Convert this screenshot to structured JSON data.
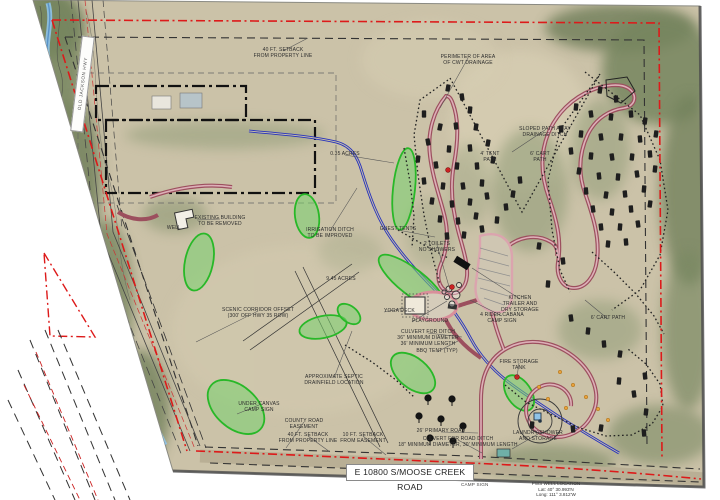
{
  "title_block": {
    "road_label": "E 10800 S/MOOSE CREEK ROAD",
    "camp_sign": "CAMP SIGN",
    "street_sign": "OLD JACKSON HWY",
    "well_note": [
      "PWS WELL LOCATION",
      "Lat: 40° 30.993'N",
      "Long: 111° 3.812'W"
    ]
  },
  "colors": {
    "boundary_red": "#dd1a1a",
    "setback_black": "#333333",
    "road_maroon": "#9c4f5e",
    "road_pink_inner": "#ddb0b8",
    "ditch_blue": "#2531bd",
    "creek_blue": "#8fc3e8",
    "vegetation_green": "#28b828",
    "tent_black": "#1e1e1e",
    "aerial_tan": "#cbc2a8"
  },
  "map": {
    "labels": [
      {
        "t": "40 FT. SETBACK\nFROM PROPERTY LINE",
        "x": 283,
        "y": 48,
        "l": [
          308,
          38
        ]
      },
      {
        "t": "PERIMETER OF AREA\nOF CWT DRAINAGE",
        "x": 468,
        "y": 55,
        "l": [
          440,
          108
        ]
      },
      {
        "t": "SLOPED PATH AWAY\nDRAINAGE DITCH",
        "x": 545,
        "y": 127,
        "l": [
          512,
          152
        ]
      },
      {
        "t": "4' TENT\nPATH",
        "x": 490,
        "y": 152
      },
      {
        "t": "6' CART\nPATH",
        "x": 540,
        "y": 152
      },
      {
        "t": "6' CART PATH",
        "x": 608,
        "y": 316,
        "l": [
          585,
          300
        ]
      },
      {
        "t": "0.35 ACRES",
        "x": 345,
        "y": 152,
        "l": [
          394,
          163
        ]
      },
      {
        "t": "GUEST TENTS",
        "x": 398,
        "y": 227,
        "l": [
          435,
          237
        ]
      },
      {
        "t": "2 TOILETS\nNO SHOWERS",
        "x": 437,
        "y": 242,
        "l": [
          450,
          290
        ]
      },
      {
        "t": "EXISTING BUILDING\nTO BE REMOVED",
        "x": 220,
        "y": 216,
        "l": [
          197,
          220
        ]
      },
      {
        "t": "WELL",
        "x": 174,
        "y": 226
      },
      {
        "t": "IRRIGATION DITCH\nTO BE IMPROVED",
        "x": 330,
        "y": 228,
        "l": [
          357,
          188
        ]
      },
      {
        "t": "SCENIC CORRIDOR OFFSET\n(300' OFF HWY 35 ROW)",
        "x": 258,
        "y": 308,
        "l": [
          196,
          342
        ]
      },
      {
        "t": "9.45 ACRES",
        "x": 341,
        "y": 277
      },
      {
        "t": "YOGA DECK",
        "x": 384,
        "y": 309,
        "a": "left",
        "l": [
          404,
          308
        ]
      },
      {
        "t": "PLAYGROUND",
        "x": 412,
        "y": 319,
        "a": "left",
        "l": [
          447,
          301
        ]
      },
      {
        "t": "CULVERT FOR DITCH\n36\" MINIMUM DIAMETER\n36' MINIMUM LENGTH",
        "x": 428,
        "y": 330,
        "l": [
          462,
          337
        ]
      },
      {
        "t": "BBQ TENT (TYP)",
        "x": 437,
        "y": 349,
        "l": [
          458,
          341
        ]
      },
      {
        "t": "KITCHEN\nTRAILER AND\nDRY STORAGE",
        "x": 520,
        "y": 296,
        "l": [
          472,
          268
        ]
      },
      {
        "t": "4 RIDER CABANA\nCAMP SIGN",
        "x": 502,
        "y": 313,
        "l": [
          470,
          300
        ]
      },
      {
        "t": "FIRE STORAGE\nTANK",
        "x": 519,
        "y": 360,
        "l": [
          517,
          377
        ]
      },
      {
        "t": "LAUNDRY/SHOWER\nAND STORAGE",
        "x": 538,
        "y": 431,
        "l": [
          512,
          449
        ]
      },
      {
        "t": "UNDER CANVAS\nCAMP SIGN",
        "x": 259,
        "y": 402,
        "l": [
          237,
          414
        ]
      },
      {
        "t": "COUNTY ROAD\nEASEMENT",
        "x": 304,
        "y": 419,
        "l": [
          286,
          448
        ]
      },
      {
        "t": "40 FT. SETBACK\nFROM PROPERTY LINE",
        "x": 308,
        "y": 433,
        "l": [
          330,
          452
        ]
      },
      {
        "t": "10 FT. SETBACK\nFROM EASEMENT",
        "x": 363,
        "y": 433,
        "l": [
          386,
          455
        ]
      },
      {
        "t": "APPROXIMATE SEPTIC\nDRAINFIELD LOCATION",
        "x": 334,
        "y": 375,
        "l": [
          352,
          331
        ]
      },
      {
        "t": "26' PRIMARY ROAD",
        "x": 441,
        "y": 429,
        "l": [
          478,
          433
        ]
      },
      {
        "t": "CULVERT FOR ROAD DITCH\n18\" MINIMUM DIAMETER, 30' MINIMUM LENGTH",
        "x": 458,
        "y": 437,
        "l": [
          482,
          453
        ]
      }
    ],
    "green_areas": [
      [
        404,
        189,
        11,
        41,
        6
      ],
      [
        307,
        216,
        12,
        22,
        -8
      ],
      [
        199,
        262,
        14,
        29,
        12
      ],
      [
        323,
        327,
        24,
        11,
        -12
      ],
      [
        412,
        282,
        41,
        13,
        38
      ],
      [
        236,
        407,
        33,
        21,
        42
      ],
      [
        413,
        373,
        26,
        15,
        40
      ],
      [
        519,
        393,
        20,
        12,
        55
      ],
      [
        349,
        314,
        13,
        8,
        38
      ]
    ],
    "tents": [
      [
        448,
        88,
        10
      ],
      [
        462,
        97,
        -8
      ],
      [
        470,
        110,
        5
      ],
      [
        424,
        114,
        0
      ],
      [
        440,
        127,
        12
      ],
      [
        456,
        126,
        -6
      ],
      [
        476,
        127,
        8
      ],
      [
        428,
        142,
        -10
      ],
      [
        449,
        149,
        4
      ],
      [
        470,
        148,
        -5
      ],
      [
        488,
        143,
        10
      ],
      [
        418,
        159,
        6
      ],
      [
        436,
        165,
        -8
      ],
      [
        457,
        166,
        5
      ],
      [
        477,
        166,
        -4
      ],
      [
        493,
        160,
        8
      ],
      [
        424,
        181,
        -6
      ],
      [
        443,
        186,
        6
      ],
      [
        463,
        186,
        -8
      ],
      [
        482,
        183,
        4
      ],
      [
        432,
        201,
        8
      ],
      [
        452,
        204,
        -5
      ],
      [
        470,
        202,
        6
      ],
      [
        487,
        196,
        -8
      ],
      [
        440,
        219,
        5
      ],
      [
        458,
        221,
        -6
      ],
      [
        476,
        216,
        8
      ],
      [
        447,
        236,
        -5
      ],
      [
        464,
        235,
        6
      ],
      [
        482,
        229,
        -8
      ],
      [
        497,
        220,
        5
      ],
      [
        506,
        207,
        -6
      ],
      [
        513,
        194,
        8
      ],
      [
        520,
        180,
        -5
      ],
      [
        600,
        90,
        8
      ],
      [
        616,
        99,
        -6
      ],
      [
        576,
        107,
        5
      ],
      [
        591,
        114,
        -8
      ],
      [
        611,
        117,
        6
      ],
      [
        631,
        114,
        -5
      ],
      [
        645,
        121,
        8
      ],
      [
        561,
        129,
        -6
      ],
      [
        581,
        134,
        5
      ],
      [
        601,
        137,
        -8
      ],
      [
        621,
        137,
        6
      ],
      [
        640,
        139,
        -5
      ],
      [
        656,
        134,
        8
      ],
      [
        571,
        151,
        -6
      ],
      [
        591,
        156,
        5
      ],
      [
        612,
        157,
        -8
      ],
      [
        632,
        157,
        6
      ],
      [
        650,
        154,
        -5
      ],
      [
        579,
        171,
        8
      ],
      [
        599,
        176,
        -6
      ],
      [
        618,
        177,
        5
      ],
      [
        637,
        174,
        -8
      ],
      [
        655,
        169,
        6
      ],
      [
        586,
        191,
        -5
      ],
      [
        606,
        195,
        8
      ],
      [
        625,
        194,
        -6
      ],
      [
        644,
        189,
        5
      ],
      [
        593,
        209,
        -8
      ],
      [
        612,
        212,
        6
      ],
      [
        631,
        209,
        -5
      ],
      [
        650,
        204,
        8
      ],
      [
        601,
        227,
        -6
      ],
      [
        620,
        227,
        5
      ],
      [
        638,
        224,
        -8
      ],
      [
        608,
        244,
        6
      ],
      [
        626,
        242,
        -5
      ],
      [
        539,
        246,
        8
      ],
      [
        563,
        261,
        -6
      ],
      [
        548,
        284,
        5
      ],
      [
        571,
        318,
        -8
      ],
      [
        588,
        331,
        6
      ],
      [
        604,
        344,
        -5
      ],
      [
        620,
        354,
        8
      ],
      [
        645,
        376,
        -6
      ],
      [
        619,
        381,
        5
      ],
      [
        634,
        394,
        -8
      ],
      [
        646,
        412,
        6
      ],
      [
        644,
        433,
        -5
      ],
      [
        601,
        428,
        8
      ],
      [
        573,
        429,
        -6
      ],
      [
        532,
        425,
        5
      ]
    ],
    "road_trees": [
      [
        428,
        398
      ],
      [
        452,
        399
      ],
      [
        419,
        416
      ],
      [
        441,
        419
      ],
      [
        463,
        426
      ],
      [
        430,
        438
      ],
      [
        453,
        441
      ]
    ],
    "dots": {
      "red": [
        [
          448,
          170
        ],
        [
          452,
          287
        ],
        [
          517,
          377
        ]
      ],
      "orange": [
        [
          560,
          372
        ],
        [
          573,
          385
        ],
        [
          586,
          397
        ],
        [
          598,
          409
        ],
        [
          608,
          420
        ],
        [
          548,
          399
        ],
        [
          539,
          387
        ],
        [
          566,
          408
        ]
      ]
    }
  }
}
